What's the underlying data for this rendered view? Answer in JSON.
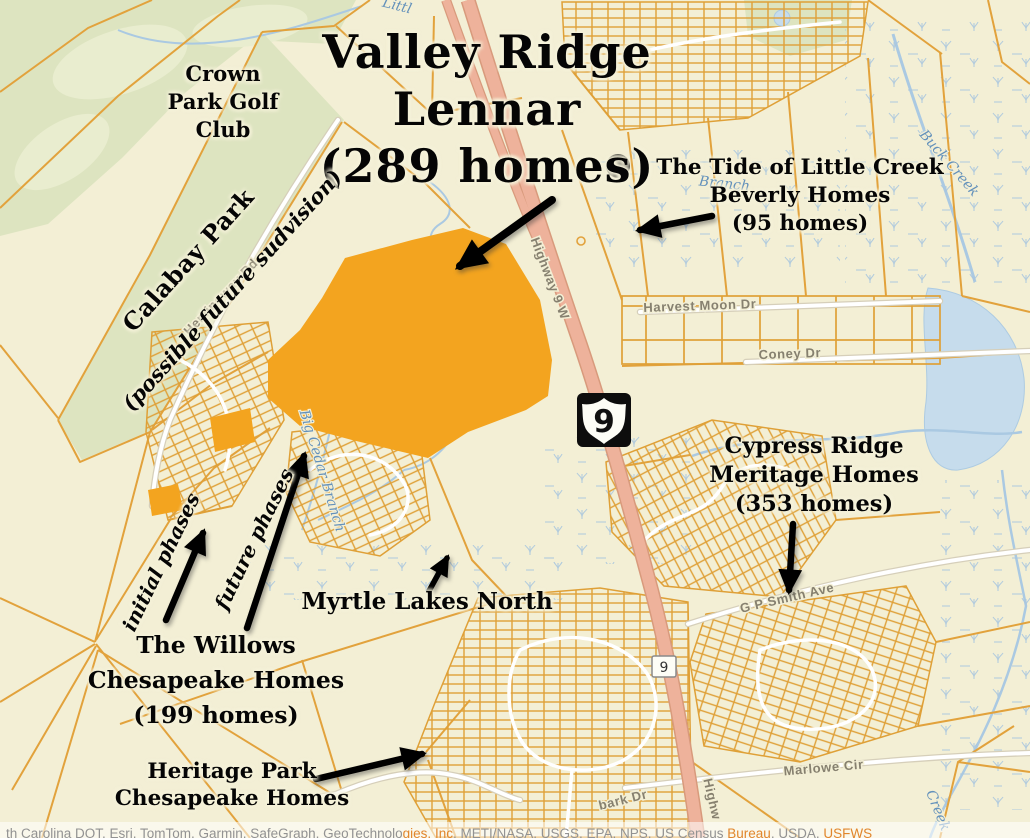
{
  "page": {
    "width": 1030,
    "height": 838
  },
  "annotations": {
    "title": {
      "lines": [
        "Valley Ridge",
        "Lennar",
        "(289 homes)"
      ]
    },
    "golf_club": {
      "lines": [
        "Crown",
        "Park Golf",
        "Club"
      ]
    },
    "calabay": {
      "name": "Calabay Park",
      "note": "(possible future sudvision)"
    },
    "tide": {
      "lines": [
        "The Tide of Little Creek",
        "Beverly Homes",
        "(95 homes)"
      ]
    },
    "cypress": {
      "lines": [
        "Cypress Ridge",
        "Meritage Homes",
        "(353 homes)"
      ]
    },
    "myrtle_lakes": {
      "name": "Myrtle Lakes North"
    },
    "willows": {
      "lines": [
        "The Willows",
        "Chesapeake Homes",
        "(199 homes)"
      ]
    },
    "heritage": {
      "lines": [
        "Heritage Park",
        "Chesapeake Homes"
      ]
    },
    "phases": {
      "initial": "initial phases",
      "future": "future phases"
    }
  },
  "road_labels": {
    "highway_9_w": "Highway 9 W",
    "hemingway_rd": "Hemingway Rd",
    "harvest_moon_dr": "Harvest Moon Dr",
    "coney_dr": "Coney Dr",
    "gp_smith_ave": "G P Smith Ave",
    "marlowe_cir": "Marlowe Cir",
    "bark_dr_partial": "bark Dr",
    "highway_partial": "Highw"
  },
  "water_labels": {
    "buck_creek": "Buck Creek",
    "big_cedar_branch": "Big Cedar Branch",
    "branch_partial": "Branch",
    "little_partial": "Littl",
    "creek_partial": "Creek"
  },
  "shields": {
    "us_9": "9",
    "route_9_small": "9"
  },
  "attribution": {
    "parts": [
      {
        "text": "th Carolina DOT, Esri, TomTom, Garmin, SafeGraph, GeoTechnolo"
      },
      {
        "text": "gies, Inc"
      },
      {
        "text": ", METI/NASA, USGS, EPA, NPS, US Census "
      },
      {
        "text": "Bureau"
      },
      {
        "text": ", USDA, "
      },
      {
        "text": "USFWS"
      }
    ]
  },
  "colors": {
    "map_background": "#f3efd5",
    "parcel_lines": "#e2a23c",
    "highlight_parcel": "#f3a41f",
    "highway_fill": "#eeb29b",
    "green_area": "#dde4c0",
    "water": "#c6dcec",
    "annotation_text": "#050505",
    "road_label": "#86806f",
    "water_label": "#6391bb",
    "attribution_link": "#e1862c"
  }
}
